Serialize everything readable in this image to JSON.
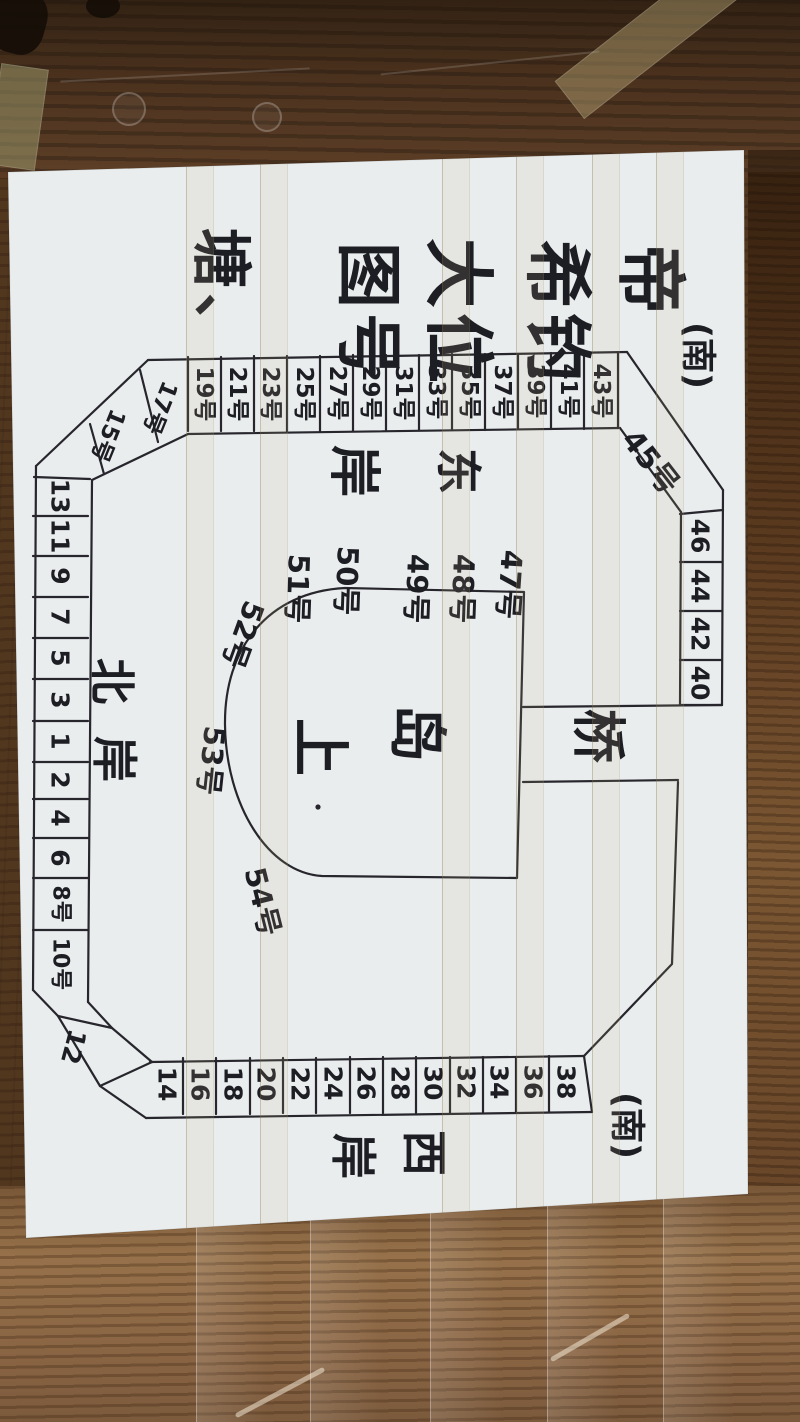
{
  "title": {
    "lines": [
      "帝",
      "希钓",
      "大位",
      "图号",
      "塘、"
    ]
  },
  "corners": {
    "south_top": "(南)",
    "south_bottom": "(南)"
  },
  "banks": {
    "east": [
      "东",
      "岸"
    ],
    "north": [
      "北",
      "岸"
    ],
    "west": [
      "西",
      "岸"
    ]
  },
  "island": {
    "chars": [
      "岛",
      "上"
    ]
  },
  "bridge": {
    "label": "桥"
  },
  "pegs": {
    "top_row": [
      "19号",
      "21号",
      "23号",
      "25号",
      "27号",
      "29号",
      "31号",
      "33号",
      "35号",
      "37号",
      "39号",
      "41号",
      "43号"
    ],
    "top_left_diagonal": [
      "17号",
      "15号"
    ],
    "left_col": [
      "13",
      "11",
      "9",
      "7",
      "5",
      "3",
      "1",
      "2",
      "4",
      "6",
      "8号",
      "10号"
    ],
    "bottom_left_diagonal": "12",
    "bottom_row": [
      "14",
      "16",
      "18",
      "20",
      "22",
      "24",
      "26",
      "28",
      "30",
      "32",
      "34",
      "36",
      "38"
    ],
    "top_right_diagonal": "45号",
    "right_col": [
      "46",
      "44",
      "42",
      "40"
    ],
    "island_ring": [
      "47号",
      "48号",
      "49号",
      "50号",
      "51号",
      "52号",
      "53号",
      "54号"
    ]
  },
  "colors": {
    "ink": "#26262c",
    "paper": "#eaedee",
    "wood_dark": "#462c18",
    "wood_light": "#96714a"
  }
}
